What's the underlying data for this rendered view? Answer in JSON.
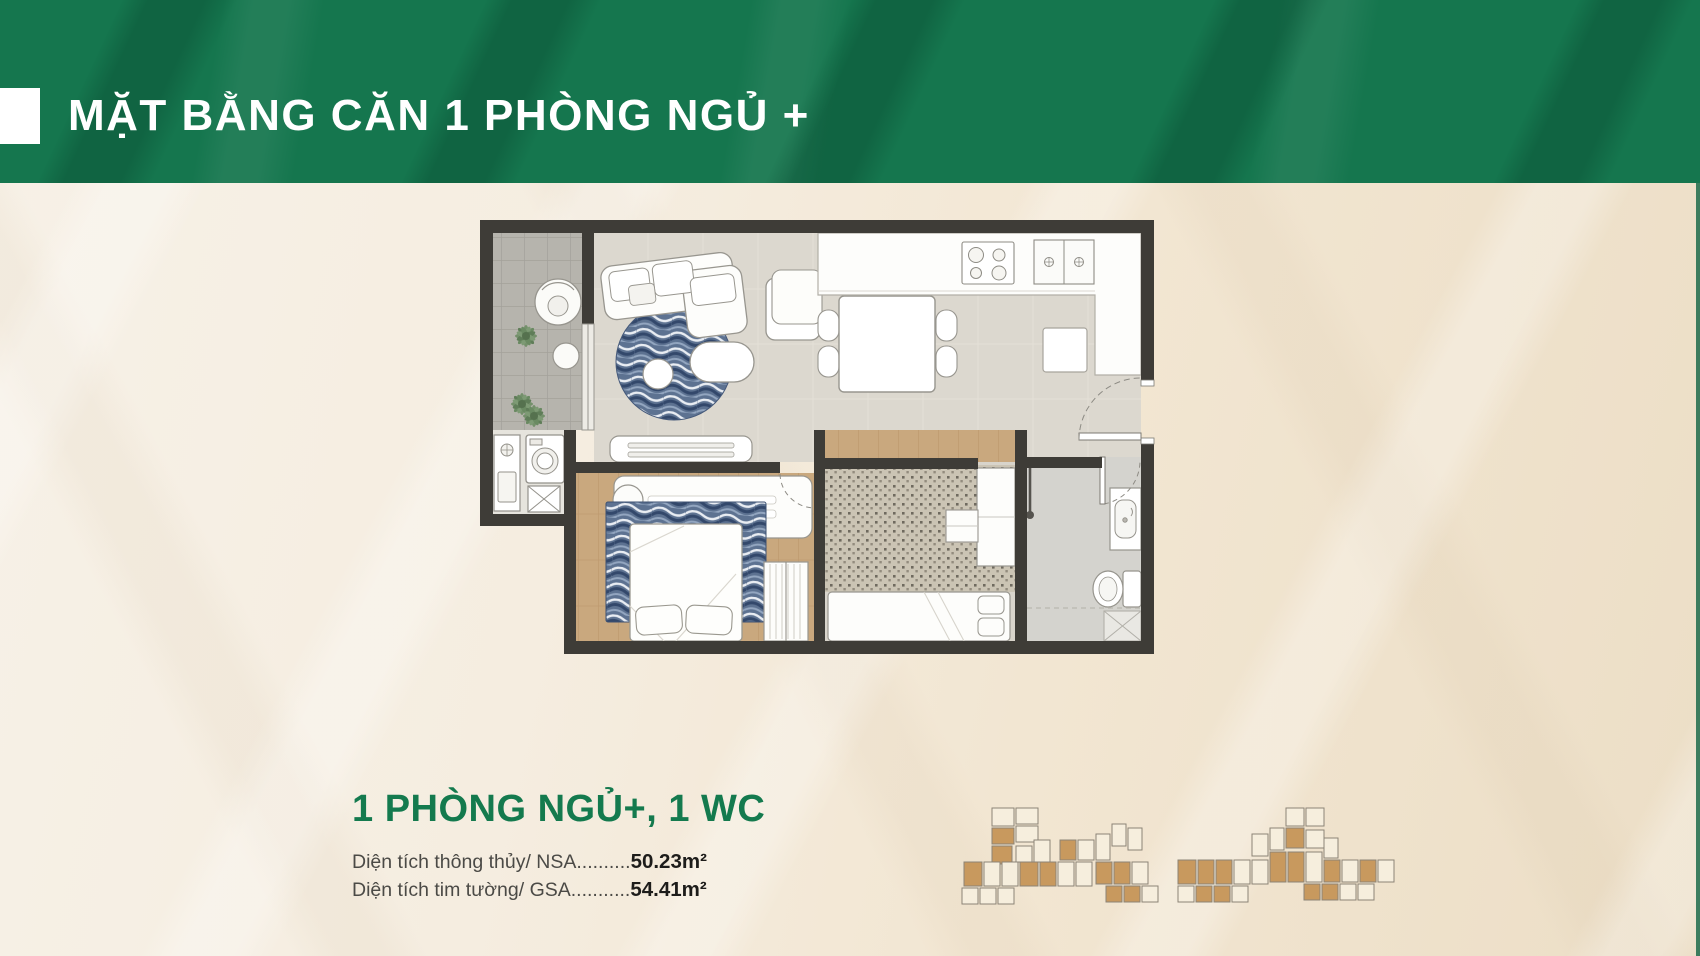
{
  "header": {
    "title": "MẶT BẰNG CĂN 1 PHÒNG NGỦ +"
  },
  "unit_info": {
    "name": "1 PHÒNG NGỦ+, 1 WC",
    "areas": [
      {
        "label": "Diện tích thông thủy/ NSA..........",
        "value": "50.23m²"
      },
      {
        "label": "Diện tích tim tường/ GSA...........",
        "value": "54.41m²"
      }
    ]
  },
  "colors": {
    "header_green": "#15764e",
    "accent_green": "#147a4e",
    "wall_dark": "#3e3c37",
    "unit_highlight_tan": "#c8995e",
    "background_cream": "#f4ecdf"
  }
}
